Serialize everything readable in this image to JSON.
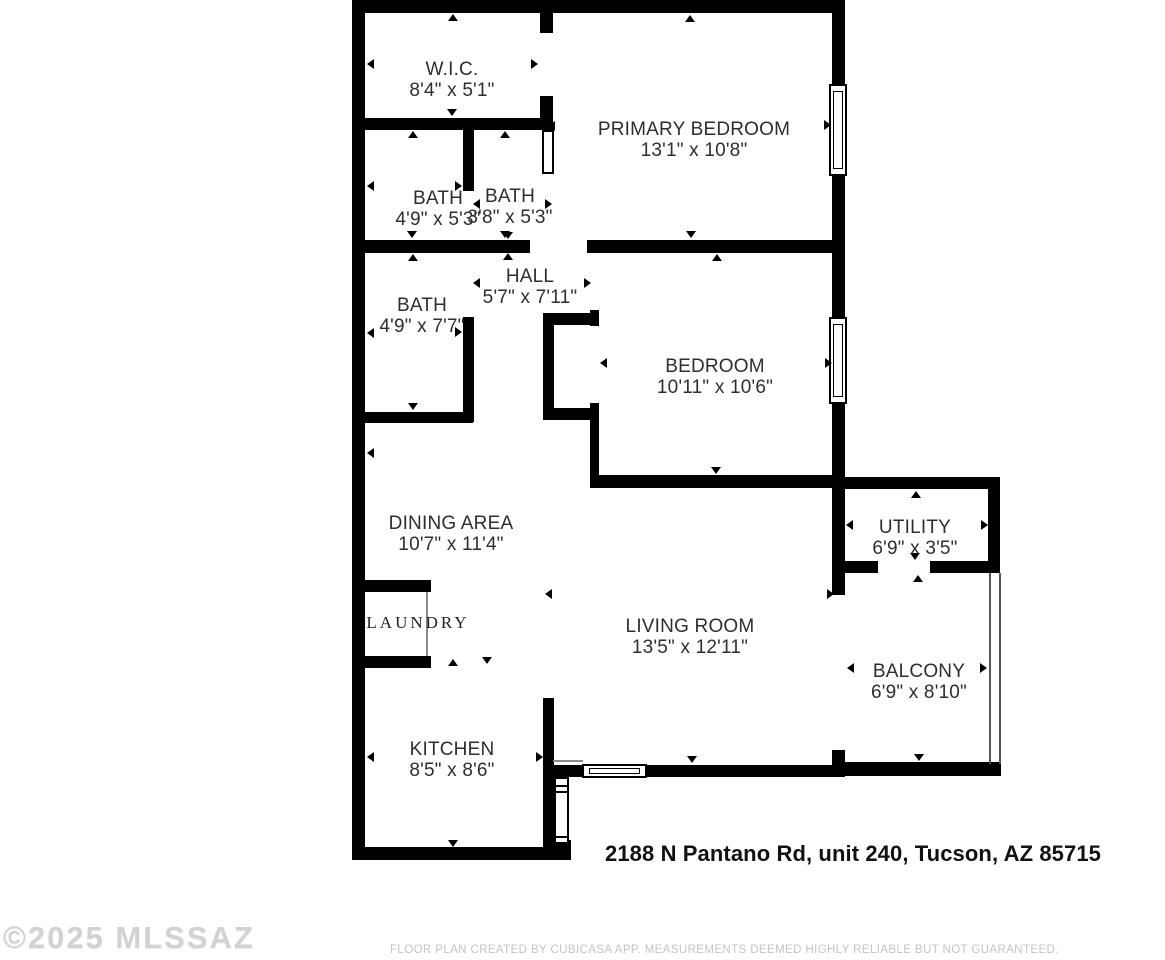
{
  "page": {
    "address": "2188 N Pantano Rd, unit 240, Tucson, AZ 85715",
    "watermark": "©2025 MLSSAZ",
    "footer": "FLOOR PLAN CREATED BY CUBICASA APP. MEASUREMENTS DEEMED HIGHLY RELIABLE BUT NOT GUARANTEED."
  },
  "colors": {
    "wall": "#000000",
    "label": "#2e2e2e",
    "address": "#111111",
    "watermark": "#d2d2d2",
    "footer": "#c4c4c4"
  },
  "rooms": [
    {
      "name": "W.I.C.",
      "dims": "8'4\" x 5'1\""
    },
    {
      "name": "PRIMARY BEDROOM",
      "dims": "13'1\" x 10'8\""
    },
    {
      "name": "BATH",
      "dims": "4'9\" x 5'3\""
    },
    {
      "name": "BATH",
      "dims": "3'8\" x 5'3\""
    },
    {
      "name": "HALL",
      "dims": "5'7\" x 7'11\""
    },
    {
      "name": "BATH",
      "dims": "4'9\" x 7'7\""
    },
    {
      "name": "BEDROOM",
      "dims": "10'11\" x 10'6\""
    },
    {
      "name": "DINING AREA",
      "dims": "10'7\" x 11'4\""
    },
    {
      "name": "UTILITY",
      "dims": "6'9\" x 3'5\""
    },
    {
      "name": "LAUNDRY",
      "dims": ""
    },
    {
      "name": "LIVING ROOM",
      "dims": "13'5\" x 12'11\""
    },
    {
      "name": "BALCONY",
      "dims": "6'9\" x 8'10\""
    },
    {
      "name": "KITCHEN",
      "dims": "8'5\" x 8'6\""
    }
  ]
}
